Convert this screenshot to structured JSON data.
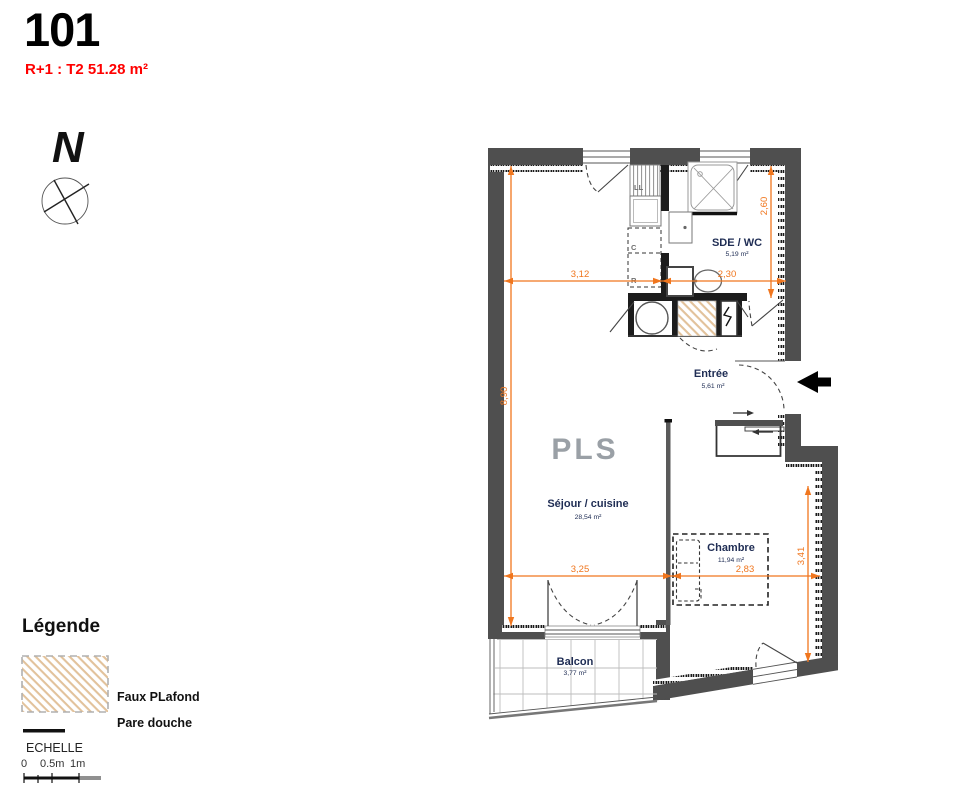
{
  "header": {
    "unit_number": "101",
    "type_label": "R+1 : T2 51.28 m²"
  },
  "compass": {
    "north_label": "N"
  },
  "plan": {
    "watermark": "PLS",
    "rooms": {
      "sde_wc": {
        "name": "SDE / WC",
        "area": "5,19 m²"
      },
      "entree": {
        "name": "Entrée",
        "area": "5,61 m²"
      },
      "sejour": {
        "name": "Séjour / cuisine",
        "area": "28,54 m²"
      },
      "chambre": {
        "name": "Chambre",
        "area": "11,94 m²"
      },
      "balcon": {
        "name": "Balcon",
        "area": "3,77 m²"
      }
    },
    "appliance_labels": {
      "washer": "LL",
      "cupboard": "C",
      "fridge": "R"
    },
    "dimensions": {
      "sejour_width_top": "3,12",
      "sde_width": "2,30",
      "sde_height": "2,60",
      "sejour_height": "8,90",
      "sejour_width_bottom": "3,25",
      "chambre_width": "2,83",
      "chambre_height": "3,41"
    }
  },
  "legend": {
    "title": "Légende",
    "faux_plafond_label": "Faux PLafond",
    "pare_douche_label": "Pare douche",
    "scale_label": "ECHELLE",
    "scale_ticks": [
      "0",
      "0.5m",
      "1m"
    ]
  },
  "colors": {
    "accent_red": "#ff0000",
    "dimension_orange": "#f0761e",
    "wall_gray": "#4f4f4f",
    "partition_black": "#1c1c1c",
    "hatch_tan": "#e2c29b",
    "room_label_navy": "#1f2d54",
    "watermark_gray": "#9aa0a6"
  }
}
